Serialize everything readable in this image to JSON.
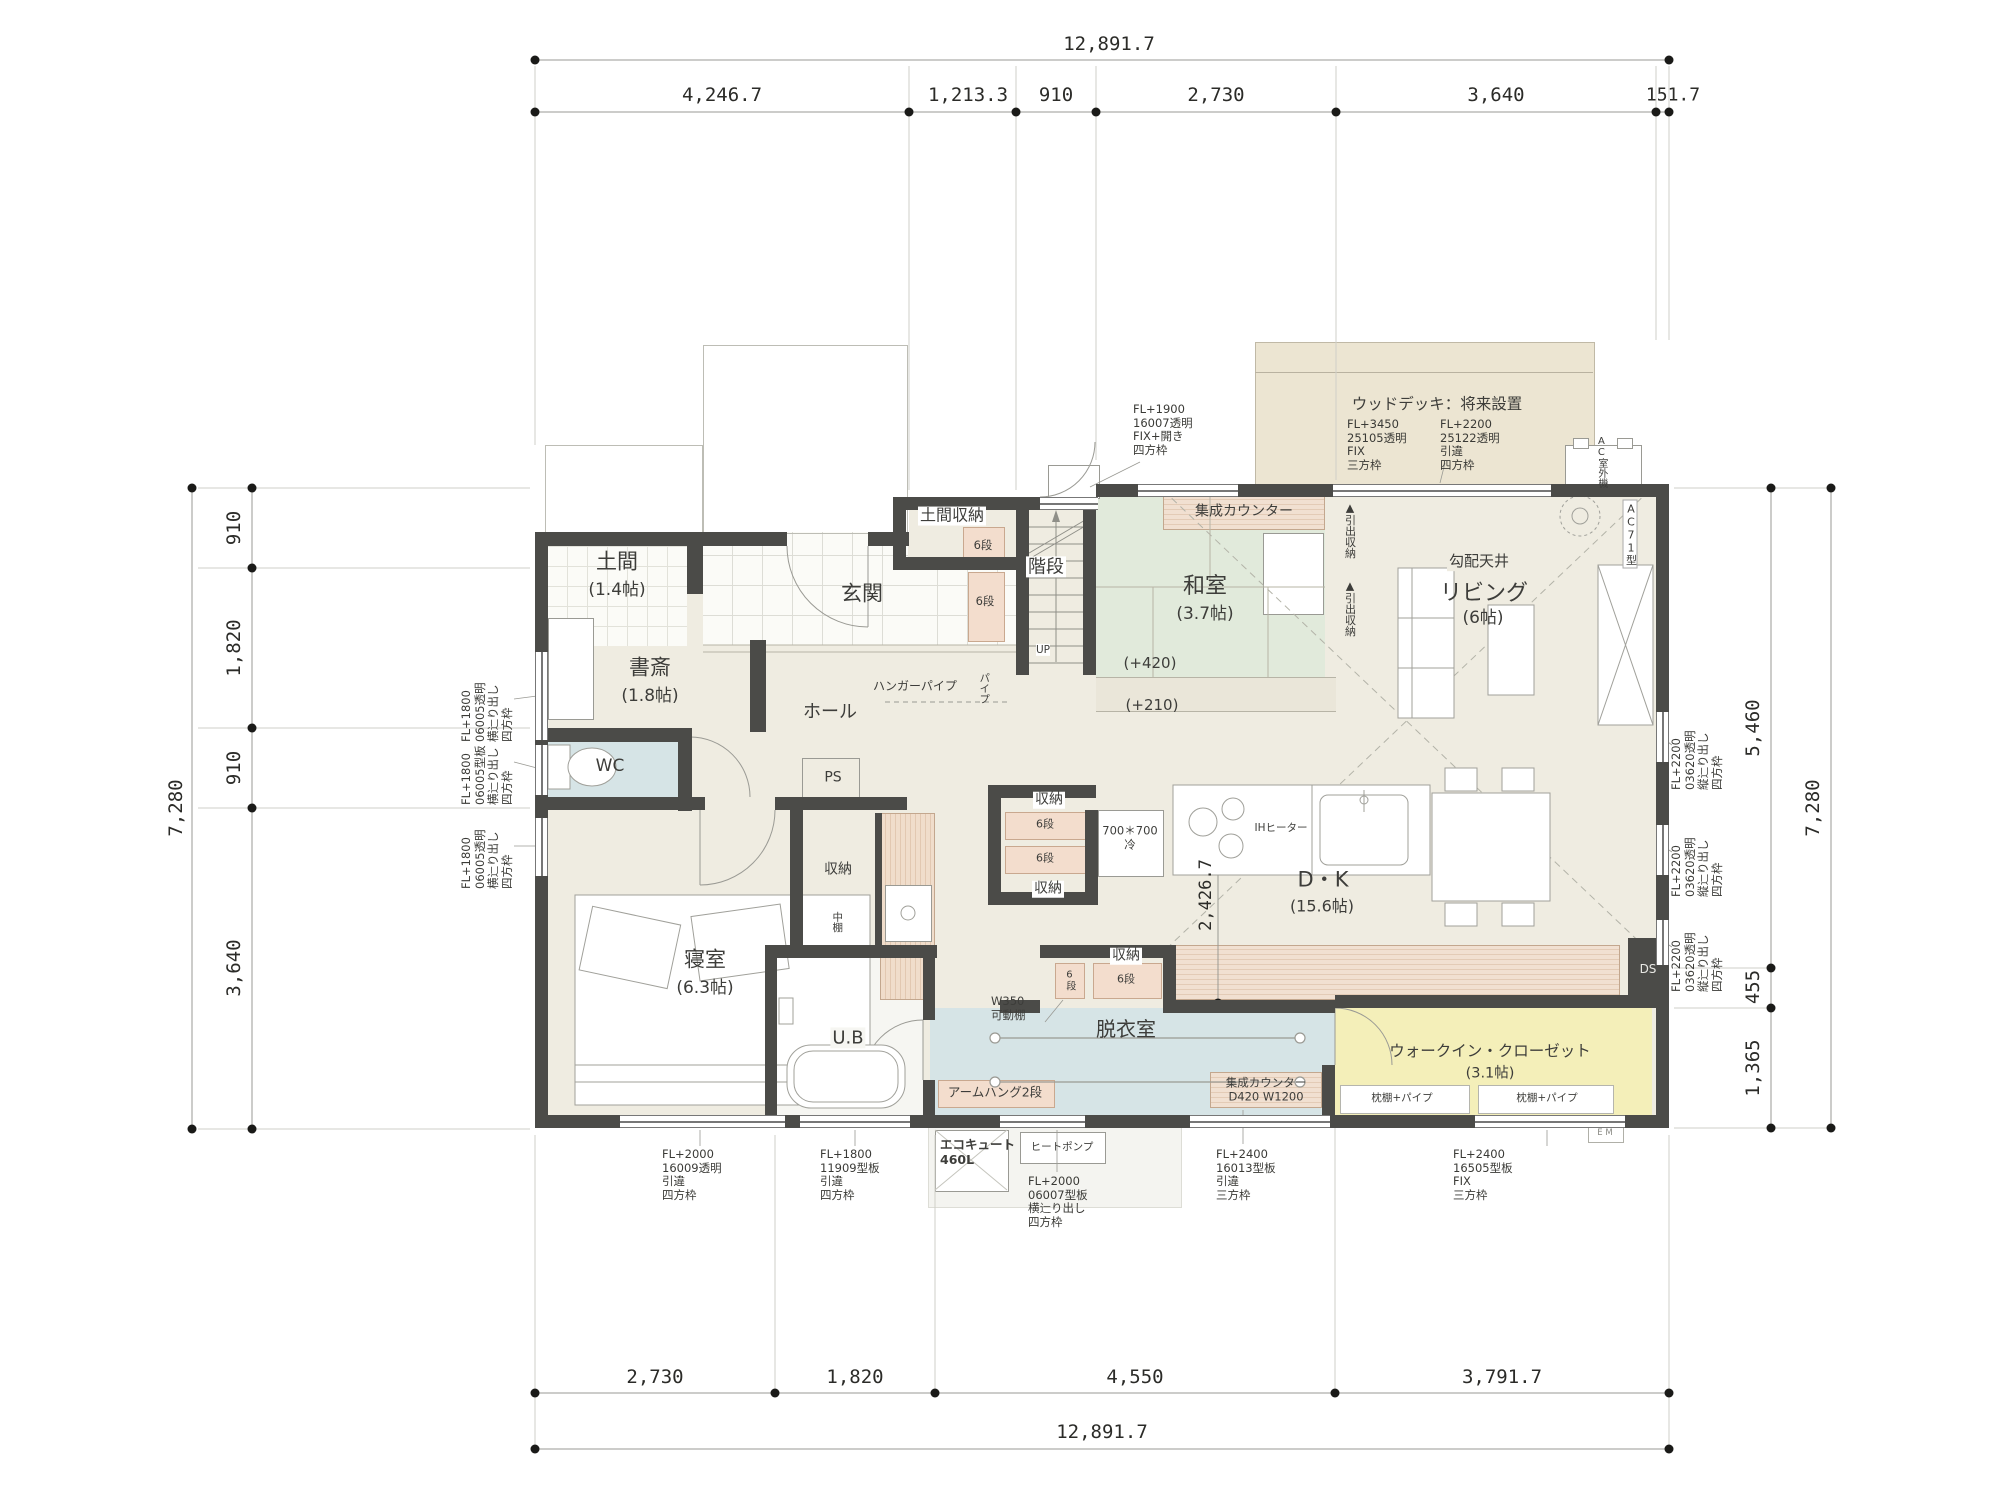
{
  "colors": {
    "wall": "#4b4b48",
    "floor": "#efece1",
    "tatami": "#e1eadb",
    "wet": "#d6e4e6",
    "wic": "#f4efb9",
    "deck": "#ece5d2",
    "closet": "#f3ddcd",
    "counter": "#e8d2bd"
  },
  "dims": {
    "top_total": "12,891.7",
    "top1": "4,246.7",
    "top2": "1,213.3",
    "top3": "910",
    "top4": "2,730",
    "top5": "3,640",
    "top6": "151.7",
    "bottom1": "2,730",
    "bottom2": "1,820",
    "bottom3": "4,550",
    "bottom4": "3,791.7",
    "bottom_total": "12,891.7",
    "left1": "910",
    "left2": "1,820",
    "left3": "910",
    "left4": "3,640",
    "left_total": "7,280",
    "right1": "5,460",
    "right2": "455",
    "right3": "1,365",
    "right_total": "7,280",
    "kitchen": "2,426.7"
  },
  "rooms": {
    "doma": {
      "name": "土間",
      "size": "(1.4帖)"
    },
    "shosai": {
      "name": "書斎",
      "size": "(1.8帖)"
    },
    "wc": {
      "name": "WC"
    },
    "genkan": {
      "name": "玄関"
    },
    "hall": {
      "name": "ホール"
    },
    "ps": {
      "name": "PS"
    },
    "domashuno": {
      "name": "土間収納",
      "dan": "6段"
    },
    "genkan_closet": {
      "dan": "6段"
    },
    "kaidan": {
      "name": "階段",
      "up": "UP"
    },
    "washitsu": {
      "name": "和室",
      "size": "(3.7帖)",
      "l1": "(+420)",
      "l2": "(+210)"
    },
    "counter_washitsu": "集成カウンター",
    "drawer1": "▲引出収納",
    "drawer2": "▲引出収納",
    "living": {
      "ceil": "勾配天井",
      "name": "リビング",
      "size": "(6帖)",
      "ac": "AC71型"
    },
    "dk": {
      "name": "D・K",
      "size": "(15.6帖)",
      "ih": "IHヒーター",
      "fridge": "700＊700\n冷"
    },
    "sto_a": {
      "name": "収納",
      "dan": "6段"
    },
    "sto_b": {
      "name": "収納",
      "dan": "6段"
    },
    "sto_c": {
      "name": "収納",
      "dan": "6段",
      "dan_v": "6段"
    },
    "datsui": {
      "name": "脱衣室",
      "w": "W350\n可動棚",
      "arm": "アームハング2段",
      "counter": "集成カウンター\nD420  W1200"
    },
    "bedroom": {
      "name": "寝室",
      "size": "(6.3帖)"
    },
    "ub": {
      "name": "U.B"
    },
    "nakadana": {
      "name": "収納",
      "v": "中棚"
    },
    "wic": {
      "name": "ウォークイン・クローゼット",
      "size": "(3.1帖)",
      "shelf_l": "枕棚+パイプ",
      "shelf_r": "枕棚+パイプ"
    },
    "hanger": "ハンガーパイプ",
    "pipe": "パイプ"
  },
  "deck": {
    "title": "ウッドデッキ：将来設置",
    "win_l": "FL+3450\n25105透明\nFIX\n三方枠",
    "win_r": "FL+2200\n25122透明\n引違\n四方枠",
    "ac": "AC室外機"
  },
  "windows": {
    "top": "FL+1900\n16007透明\nFIX+開き\n四方枠",
    "left1": "FL+1800\n06005透明\n横辷り出し\n四方枠",
    "left2": "FL+1800\n06005型板\n横辷り出し\n四方枠",
    "left3": "FL+1800\n06005透明\n横辷り出し\n四方枠",
    "right1": "FL+2200\n03620透明\n縦辷り出し\n四方枠",
    "right2": "FL+2200\n03620透明\n縦辷り出し\n四方枠",
    "right3": "FL+2200\n03620透明\n縦辷り出し\n四方枠",
    "bottom1": "FL+2000\n16009透明\n引違\n四方枠",
    "bottom2": "FL+1800\n11909型板\n引違\n四方枠",
    "bottom3": "FL+2000\n06007型板\n横辷り出し\n四方枠",
    "bottom4": "FL+2400\n16013型板\n引違\n三方枠",
    "bottom5": "FL+2400\n16505型板\nFIX\n三方枠"
  },
  "equipment": {
    "ecocute": "エコキュート\n460L",
    "heatpump": "ヒートポンプ",
    "ds": "DS",
    "em": "E M"
  }
}
